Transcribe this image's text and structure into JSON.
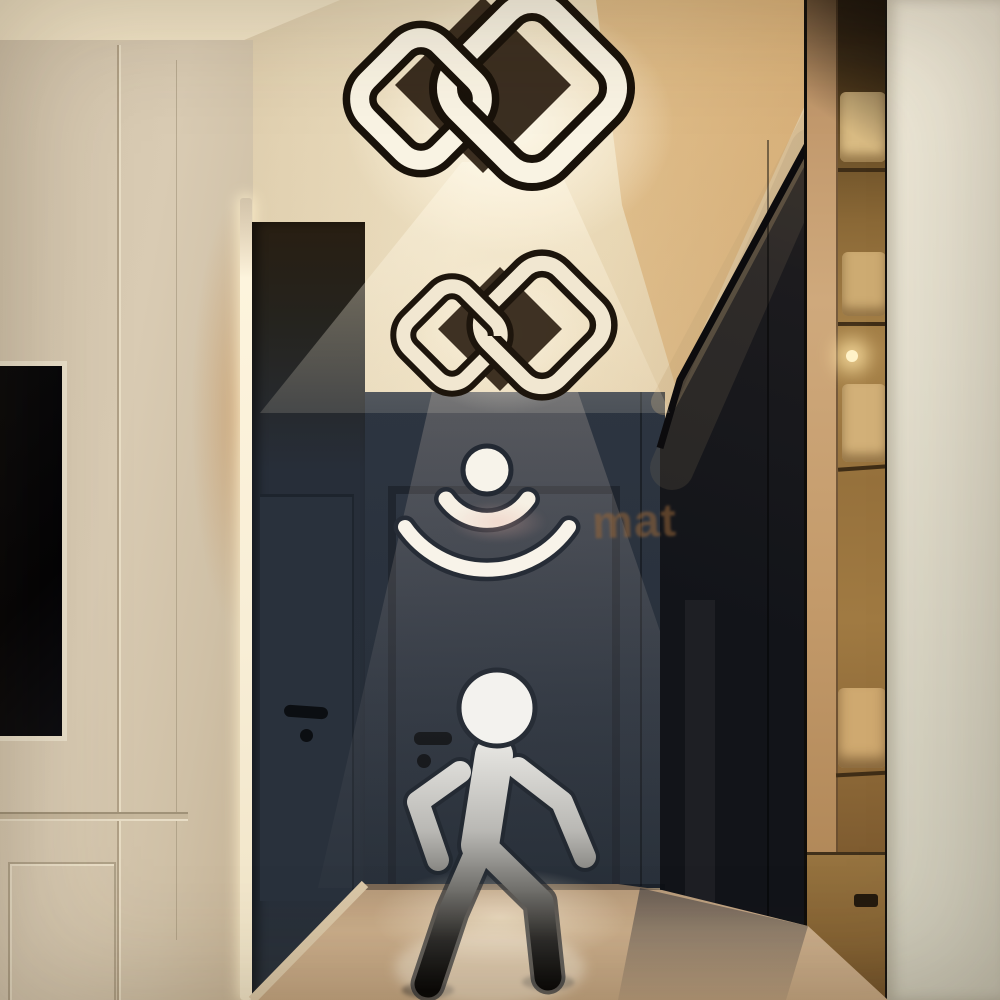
{
  "image": {
    "type": "product-lifestyle-photo",
    "subject": "Modern black interlocked-square LED ceiling lamps with motion sensor in a hallway",
    "watermark": {
      "visible_fragment": "mat"
    }
  },
  "overlays": {
    "motion_sensor_icon": "dot-with-two-radiating-arcs",
    "walking_person_icon": "walking-man-pictogram",
    "ceiling_lamp_count": 2
  },
  "palette": {
    "ceiling_cream": "#ecdcbb",
    "ceiling_gold": "#d9b98c",
    "left_wall": "#d5c7af",
    "tv_black": "#070709",
    "led_strip": "#fdf4dd",
    "hall_wall_navy": "#2b333f",
    "door_navy": "#2a323d",
    "glass_dark": "#191a1f",
    "wardrobe_gold": "#a57c44",
    "pillar_cream": "#e7e2d2",
    "floor_tan": "#c9ac8a",
    "lamp_white": "#f8f1e0",
    "icon_white": "#f6f2e8",
    "figure_gray_top": "#e6e5e1",
    "figure_black_bottom": "#060606"
  }
}
